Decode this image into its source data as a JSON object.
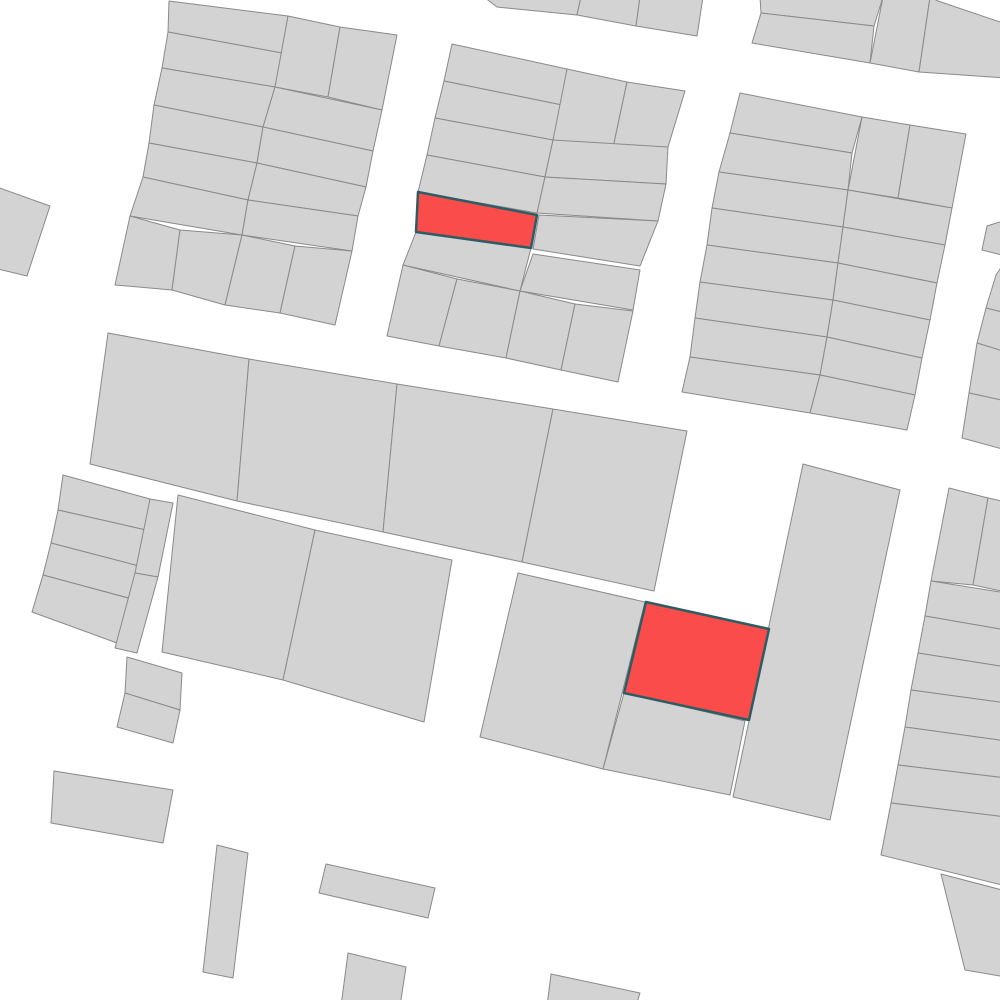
{
  "map": {
    "type": "cadastral-parcel-map",
    "canvas": {
      "width": 1000,
      "height": 1000
    },
    "palette": {
      "background_color": "#ffffff",
      "parcel_fill": "#d3d3d3",
      "parcel_stroke": "#8a8a8a",
      "parcel_stroke_width": 1,
      "highlight_fill": "#fb4c4c",
      "highlight_stroke": "#2d5d64",
      "highlight_stroke_width": 2.5
    },
    "selected_parcel_count": 2,
    "parcels": [
      {
        "name": "parcel-topleft-row1",
        "highlighted": false,
        "points": "169,1 288,16 282,53 168,32"
      },
      {
        "name": "parcel-topleft-row2",
        "highlighted": false,
        "points": "168,32 282,53 275,87 162,68"
      },
      {
        "name": "parcel-topleft-row3",
        "highlighted": false,
        "points": "162,68 275,87 263,127 154,105"
      },
      {
        "name": "parcel-topleft-row4",
        "highlighted": false,
        "points": "154,105 263,127 257,163 149,143"
      },
      {
        "name": "parcel-topleft-row5",
        "highlighted": false,
        "points": "149,143 257,163 248,200 143,177"
      },
      {
        "name": "parcel-topleft-row6",
        "highlighted": false,
        "points": "143,177 248,200 242,235 130,216"
      },
      {
        "name": "parcel-topleft-bottom1",
        "highlighted": false,
        "points": "130,216 180,230 172,290 115,285"
      },
      {
        "name": "parcel-topleft-bottom2",
        "highlighted": false,
        "points": "180,230 242,235 225,305 172,290"
      },
      {
        "name": "parcel-topleft-bottom3",
        "highlighted": false,
        "points": "242,235 295,246 280,313 225,305"
      },
      {
        "name": "parcel-topleft-bottom4",
        "highlighted": false,
        "points": "295,246 352,251 335,325 280,313"
      },
      {
        "name": "parcel-topleft-corner1",
        "highlighted": false,
        "points": "288,16 340,27 328,97 275,87"
      },
      {
        "name": "parcel-topleft-corner2",
        "highlighted": false,
        "points": "340,27 397,35 382,110 328,97"
      },
      {
        "name": "parcel-topleft-east1",
        "highlighted": false,
        "points": "275,87 382,110 373,151 263,127"
      },
      {
        "name": "parcel-topleft-east2",
        "highlighted": false,
        "points": "263,127 373,151 366,187 257,163"
      },
      {
        "name": "parcel-topleft-east3",
        "highlighted": false,
        "points": "257,163 366,187 358,216 248,200"
      },
      {
        "name": "parcel-topleft-east4",
        "highlighted": false,
        "points": "248,200 358,216 352,251 242,235"
      },
      {
        "name": "parcel-west-edge",
        "highlighted": false,
        "points": "-6,186 50,206 27,276 -6,268"
      },
      {
        "name": "parcel-topsliver-1",
        "highlighted": false,
        "points": "484,-3 581,-3 577,15 497,7"
      },
      {
        "name": "parcel-topsliver-2",
        "highlighted": false,
        "points": "581,-3 640,-3 636,26 577,15"
      },
      {
        "name": "parcel-topsliver-3",
        "highlighted": false,
        "points": "640,-3 703,-3 697,36 636,26"
      },
      {
        "name": "parcel-topright-strip1",
        "highlighted": false,
        "points": "760,-3 883,-3 874,26 761,13"
      },
      {
        "name": "parcel-topright-strip2",
        "highlighted": false,
        "points": "761,13 874,26 870,63 752,43"
      },
      {
        "name": "parcel-topright-strip3",
        "highlighted": false,
        "points": "883,-3 930,-3 919,72 870,63"
      },
      {
        "name": "parcel-topright-strip4",
        "highlighted": false,
        "points": "930,-3 938,1 1006,24 1006,78 919,72"
      },
      {
        "name": "parcel-topmid-row1",
        "highlighted": false,
        "points": "452,44 567,69 562,105 444,81"
      },
      {
        "name": "parcel-topmid-row2",
        "highlighted": false,
        "points": "444,81 562,105 553,140 435,118"
      },
      {
        "name": "parcel-topmid-row3",
        "highlighted": false,
        "points": "435,118 553,140 545,177 427,155"
      },
      {
        "name": "parcel-topmid-row4",
        "highlighted": false,
        "points": "427,155 545,177 537,213 418,192"
      },
      {
        "name": "parcel-topmid-row6",
        "highlighted": false,
        "points": "416,232 531,248 520,291 403,265"
      },
      {
        "name": "parcel-topmid-bottom1",
        "highlighted": false,
        "points": "403,265 457,279 439,346 387,336"
      },
      {
        "name": "parcel-topmid-bottom2",
        "highlighted": false,
        "points": "457,279 520,291 506,358 439,346"
      },
      {
        "name": "parcel-topmid-bottom3",
        "highlighted": false,
        "points": "520,291 575,304 561,370 506,358"
      },
      {
        "name": "parcel-topmid-bottom4",
        "highlighted": false,
        "points": "575,304 633,311 618,382 561,370"
      },
      {
        "name": "parcel-topmid-corner1",
        "highlighted": false,
        "points": "567,69 627,82 613,148 553,140"
      },
      {
        "name": "parcel-topmid-corner2",
        "highlighted": false,
        "points": "627,82 685,91 668,147 613,148"
      },
      {
        "name": "parcel-topmid-east1",
        "highlighted": false,
        "points": "553,140 668,147 666,184 545,177"
      },
      {
        "name": "parcel-topmid-east2",
        "highlighted": false,
        "points": "545,177 666,184 658,221 537,213"
      },
      {
        "name": "parcel-topmid-east3",
        "highlighted": false,
        "points": "539,215 658,221 640,266 533,249"
      },
      {
        "name": "parcel-topmid-east4",
        "highlighted": false,
        "points": "533,254 640,270 633,310 520,291"
      },
      {
        "name": "parcel-topright-row1",
        "highlighted": false,
        "points": "740,93 862,117 852,153 730,133"
      },
      {
        "name": "parcel-topright-row2",
        "highlighted": false,
        "points": "730,133 852,153 848,190 719,172"
      },
      {
        "name": "parcel-topright-row3",
        "highlighted": false,
        "points": "719,172 848,190 843,227 712,208"
      },
      {
        "name": "parcel-topright-row4",
        "highlighted": false,
        "points": "712,208 843,227 838,263 707,245"
      },
      {
        "name": "parcel-topright-row5",
        "highlighted": false,
        "points": "707,245 838,263 833,300 700,282"
      },
      {
        "name": "parcel-topright-row6",
        "highlighted": false,
        "points": "700,282 833,300 827,337 695,318"
      },
      {
        "name": "parcel-topright-row7",
        "highlighted": false,
        "points": "695,318 827,337 820,375 690,357"
      },
      {
        "name": "parcel-topright-row8",
        "highlighted": false,
        "points": "690,357 820,375 810,413 682,392"
      },
      {
        "name": "parcel-topright-corner1",
        "highlighted": false,
        "points": "862,117 910,125 898,198 848,190"
      },
      {
        "name": "parcel-topright-corner2",
        "highlighted": false,
        "points": "910,125 966,134 952,208 898,198"
      },
      {
        "name": "parcel-topright-east1",
        "highlighted": false,
        "points": "848,190 952,208 945,245 843,227"
      },
      {
        "name": "parcel-topright-east2",
        "highlighted": false,
        "points": "843,227 945,245 937,283 838,263"
      },
      {
        "name": "parcel-topright-east3",
        "highlighted": false,
        "points": "838,263 937,283 930,320 833,300"
      },
      {
        "name": "parcel-topright-east4",
        "highlighted": false,
        "points": "833,300 930,320 922,358 827,337"
      },
      {
        "name": "parcel-topright-east5",
        "highlighted": false,
        "points": "827,337 922,358 915,395 820,375"
      },
      {
        "name": "parcel-topright-east6",
        "highlighted": false,
        "points": "820,375 915,395 907,430 810,413"
      },
      {
        "name": "parcel-east-edge-top",
        "highlighted": false,
        "points": "987,226 1006,220 1006,256 982,250"
      },
      {
        "name": "parcel-east-edge-1",
        "highlighted": false,
        "points": "996,275 1006,260 1006,313 986,308"
      },
      {
        "name": "parcel-east-edge-2",
        "highlighted": false,
        "points": "986,308 1006,313 1006,352 977,343"
      },
      {
        "name": "parcel-east-edge-3",
        "highlighted": false,
        "points": "977,343 1006,352 1006,401 969,393"
      },
      {
        "name": "parcel-east-edge-4",
        "highlighted": false,
        "points": "969,393 1006,401 1006,450 962,438"
      },
      {
        "name": "parcel-midrow-big1",
        "highlighted": false,
        "points": "108,333 249,359 237,501 90,464"
      },
      {
        "name": "parcel-midrow-big2",
        "highlighted": false,
        "points": "249,359 397,384 383,532 237,501"
      },
      {
        "name": "parcel-midrow-big3",
        "highlighted": false,
        "points": "397,384 553,409 522,562 383,532"
      },
      {
        "name": "parcel-midrow-big4",
        "highlighted": false,
        "points": "553,409 687,431 654,591 522,562"
      },
      {
        "name": "parcel-midrow2-big1",
        "highlighted": false,
        "points": "178,495 315,530 283,680 162,652"
      },
      {
        "name": "parcel-midrow2-big2",
        "highlighted": false,
        "points": "315,530 452,560 424,722 283,680"
      },
      {
        "name": "parcel-westblock-row1",
        "highlighted": false,
        "points": "63,475 150,499 146,530 58,510"
      },
      {
        "name": "parcel-westblock-row2",
        "highlighted": false,
        "points": "58,510 146,530 139,566 51,543"
      },
      {
        "name": "parcel-westblock-row3",
        "highlighted": false,
        "points": "51,543 139,566 132,599 43,575"
      },
      {
        "name": "parcel-westblock-row4",
        "highlighted": false,
        "points": "43,575 132,599 117,643 32,612"
      },
      {
        "name": "parcel-westblock-strip1",
        "highlighted": false,
        "points": "150,499 173,503 158,577 135,573"
      },
      {
        "name": "parcel-westblock-strip2",
        "highlighted": false,
        "points": "135,573 158,577 137,653 115,648"
      },
      {
        "name": "parcel-detached-1",
        "highlighted": false,
        "points": "127,657 182,673 180,710 125,693"
      },
      {
        "name": "parcel-detached-2",
        "highlighted": false,
        "points": "125,693 180,710 173,743 117,727"
      },
      {
        "name": "parcel-southmid-west",
        "highlighted": false,
        "points": "518,573 645,602 603,769 480,737"
      },
      {
        "name": "parcel-southmid-below-selection",
        "highlighted": false,
        "points": "624,693 745,721 730,795 603,769"
      },
      {
        "name": "parcel-southmid-strip",
        "highlighted": false,
        "points": "803,464 900,490 830,820 733,797"
      },
      {
        "name": "parcel-southeast-corner1",
        "highlighted": false,
        "points": "949,488 988,498 973,585 931,581"
      },
      {
        "name": "parcel-southeast-corner2",
        "highlighted": false,
        "points": "988,498 1006,502 1006,592 973,585"
      },
      {
        "name": "parcel-southeast-row1",
        "highlighted": false,
        "points": "931,581 1006,593 1006,630 925,616"
      },
      {
        "name": "parcel-southeast-row2",
        "highlighted": false,
        "points": "925,616 1006,630 1006,667 918,653"
      },
      {
        "name": "parcel-southeast-row3",
        "highlighted": false,
        "points": "918,653 1006,667 1006,703 911,690"
      },
      {
        "name": "parcel-southeast-row4",
        "highlighted": false,
        "points": "911,690 1006,703 1006,741 905,727"
      },
      {
        "name": "parcel-southeast-row5",
        "highlighted": false,
        "points": "905,727 1006,741 1006,778 898,765"
      },
      {
        "name": "parcel-southeast-row6",
        "highlighted": false,
        "points": "898,765 1006,778 1006,817 891,803"
      },
      {
        "name": "parcel-southeast-row7",
        "highlighted": false,
        "points": "891,803 1006,817 1006,886 881,855"
      },
      {
        "name": "parcel-south-scatter1",
        "highlighted": false,
        "points": "54,771 173,790 163,843 51,823"
      },
      {
        "name": "parcel-south-scatter2",
        "highlighted": false,
        "points": "217,845 248,853 233,978 203,972"
      },
      {
        "name": "parcel-south-scatter3",
        "highlighted": false,
        "points": "326,864 435,888 428,918 319,893"
      },
      {
        "name": "parcel-south-scatter4",
        "highlighted": false,
        "points": "348,953 406,967 400,1006 341,1006"
      },
      {
        "name": "parcel-south-scatter5",
        "highlighted": false,
        "points": "551,974 640,993 636,1006 547,1006"
      },
      {
        "name": "parcel-south-scatter6",
        "highlighted": false,
        "points": "941,874 1006,891 1006,977 965,970"
      },
      {
        "name": "selected-parcel-1",
        "highlighted": true,
        "points": "418,192 537,215 531,248 416,232"
      },
      {
        "name": "selected-parcel-2",
        "highlighted": true,
        "points": "646,602 769,629 749,720 624,693"
      }
    ]
  }
}
